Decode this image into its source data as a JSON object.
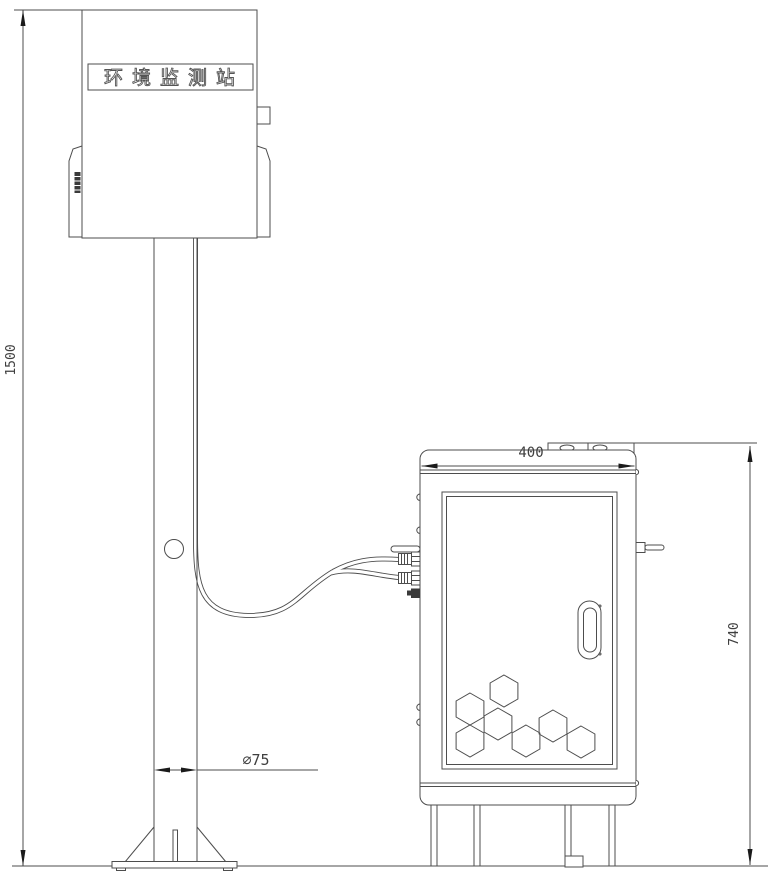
{
  "drawing": {
    "type": "technical-line-drawing",
    "subject": "environmental monitoring station pole and equipment cabinet",
    "background_color": "#ffffff",
    "line_color": "#4d4d4d",
    "station": {
      "nameplate_label": "环境监测站"
    },
    "dimensions": {
      "pole_height": "1500",
      "pole_diameter": "∅75",
      "cabinet_width": "400",
      "cabinet_height": "740"
    }
  }
}
